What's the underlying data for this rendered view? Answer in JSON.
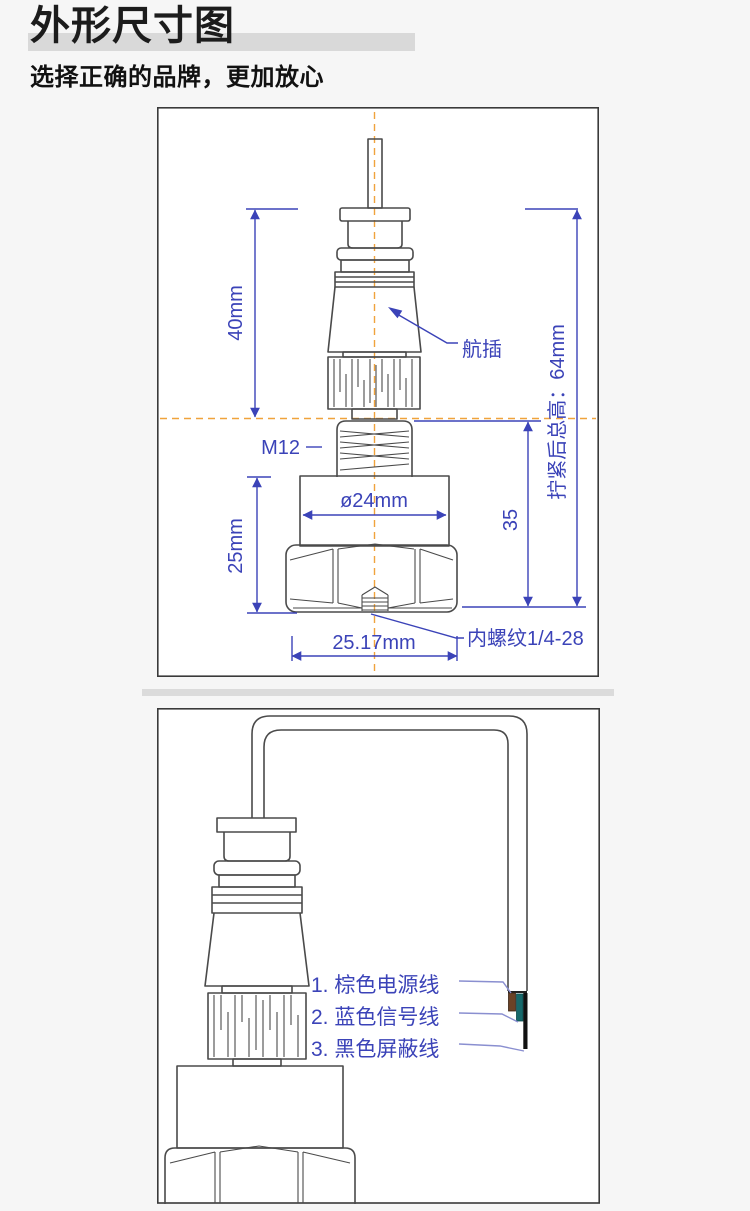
{
  "header": {
    "title": "外形尺寸图",
    "subtitle": "选择正确的品牌，更加放心"
  },
  "outline_diagram": {
    "dims": {
      "connector_height": "40mm",
      "total_height": "拧紧后总高：64mm",
      "thread": "M12",
      "diameter": "ø24mm",
      "body_height": "25mm",
      "sensor_height": "35",
      "hex_width": "25.17mm"
    },
    "labels": {
      "connector": "航插",
      "internal_thread": "内螺纹1/4-28"
    }
  },
  "wiring_diagram": {
    "wires": [
      {
        "label": "1. 棕色电源线",
        "color": "#6b4226"
      },
      {
        "label": "2. 蓝色信号线",
        "color": "#17696b"
      },
      {
        "label": "3. 黑色屏蔽线",
        "color": "#111111"
      }
    ]
  },
  "colors": {
    "dimension_blue": "#3b43b8",
    "centerline_orange": "#f0a33c",
    "leader_light_blue": "#8a8fd0",
    "outline_gray": "#4a4a4a"
  }
}
